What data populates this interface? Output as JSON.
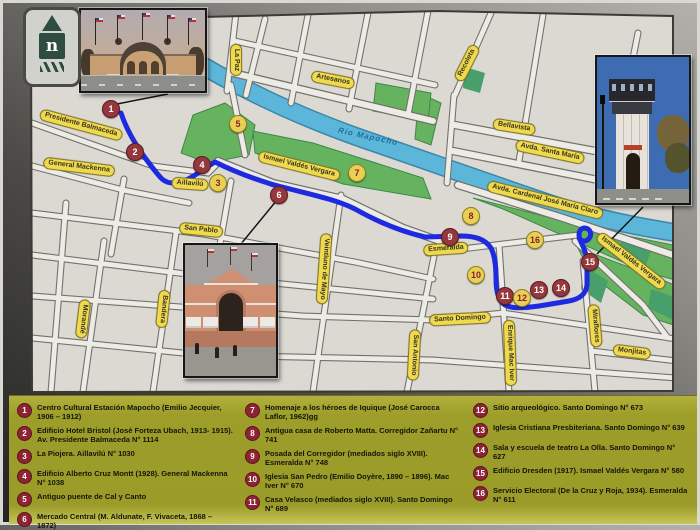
{
  "map": {
    "logo_letter": "n",
    "route_color": "#1e2ae0",
    "colors": {
      "paper": "#dcd9d3",
      "street": "#edebe6",
      "street_casing": "#72726c",
      "river": "#5cb6da",
      "park": "#66b35f",
      "park_dark": "#47a06b",
      "badge_bg": "#eed94f",
      "marker_red": "#94383d",
      "marker_yellow": "#e7d054"
    },
    "street_labels": [
      {
        "t": "Presidente Balmaceda",
        "x": 78,
        "y": 122,
        "r": 15
      },
      {
        "t": "General Mackenna",
        "x": 76,
        "y": 164,
        "r": 7
      },
      {
        "t": "Aillavilú",
        "x": 187,
        "y": 181,
        "r": 4
      },
      {
        "t": "San Pablo",
        "x": 198,
        "y": 227,
        "r": 6
      },
      {
        "t": "Artesanos",
        "x": 330,
        "y": 77,
        "r": 11
      },
      {
        "t": "La Paz",
        "x": 233,
        "y": 57,
        "r": 90
      },
      {
        "t": "Recoleta",
        "x": 464,
        "y": 60,
        "r": -63
      },
      {
        "t": "Bellavista",
        "x": 511,
        "y": 124,
        "r": 9
      },
      {
        "t": "Avda. Santa María",
        "x": 547,
        "y": 149,
        "r": 12
      },
      {
        "t": "Avda. Cardenal José María Claro",
        "x": 542,
        "y": 197,
        "r": 14
      },
      {
        "t": "Ismael Valdés Vergara",
        "x": 296,
        "y": 163,
        "r": 14
      },
      {
        "t": "Ismael Valdés Vergara",
        "x": 628,
        "y": 258,
        "r": 38
      },
      {
        "t": "Esmeralda",
        "x": 443,
        "y": 246,
        "r": -4
      },
      {
        "t": "Santo Domingo",
        "x": 457,
        "y": 316,
        "r": -3
      },
      {
        "t": "Morandé",
        "x": 80,
        "y": 316,
        "r": 97
      },
      {
        "t": "Bandera",
        "x": 160,
        "y": 306,
        "r": 96
      },
      {
        "t": "Veintiuno de Mayo",
        "x": 321,
        "y": 266,
        "r": 94
      },
      {
        "t": "San Antonio",
        "x": 411,
        "y": 352,
        "r": 93
      },
      {
        "t": "Enrique Mac Iver",
        "x": 507,
        "y": 350,
        "r": 88
      },
      {
        "t": "Miraflores",
        "x": 592,
        "y": 323,
        "r": 85
      },
      {
        "t": "Monjitas",
        "x": 629,
        "y": 349,
        "r": 7
      },
      {
        "t": "Río Mapocho",
        "x": 365,
        "y": 134,
        "r": 12,
        "style": "river"
      }
    ],
    "markers": [
      {
        "t": "1",
        "x": 108,
        "y": 106,
        "style": "red"
      },
      {
        "t": "2",
        "x": 132,
        "y": 149,
        "style": "red"
      },
      {
        "t": "3",
        "x": 215,
        "y": 180,
        "style": "yellow"
      },
      {
        "t": "4",
        "x": 199,
        "y": 162,
        "style": "red"
      },
      {
        "t": "5",
        "x": 235,
        "y": 121,
        "style": "yellow"
      },
      {
        "t": "6",
        "x": 276,
        "y": 192,
        "style": "red"
      },
      {
        "t": "7",
        "x": 354,
        "y": 170,
        "style": "yellow"
      },
      {
        "t": "8",
        "x": 468,
        "y": 213,
        "style": "yellow"
      },
      {
        "t": "9",
        "x": 447,
        "y": 234,
        "style": "red"
      },
      {
        "t": "10",
        "x": 473,
        "y": 272,
        "style": "yellow"
      },
      {
        "t": "11",
        "x": 502,
        "y": 293,
        "style": "red"
      },
      {
        "t": "12",
        "x": 519,
        "y": 295,
        "style": "yellow"
      },
      {
        "t": "13",
        "x": 536,
        "y": 287,
        "style": "red"
      },
      {
        "t": "14",
        "x": 558,
        "y": 285,
        "style": "red"
      },
      {
        "t": "15",
        "x": 587,
        "y": 259,
        "style": "red"
      },
      {
        "t": "16",
        "x": 532,
        "y": 237,
        "style": "yellow"
      }
    ]
  },
  "legend": {
    "col1": [
      {
        "n": "1",
        "t": "Centro Cultural Estación Mapocho (Emilio Jecquier, 1906 – 1912)"
      },
      {
        "n": "2",
        "t": "Edificio Hotel Bristol (José Forteza Ubach, 1913- 1915). Av. Presidente Balmaceda N° 1114"
      },
      {
        "n": "3",
        "t": "La Piojera. Aillavilú N° 1030"
      },
      {
        "n": "4",
        "t": "Edificio Alberto Cruz Montt (1928). General Mackenna N° 1038"
      },
      {
        "n": "5",
        "t": "Antiguo puente de Cal y Canto"
      },
      {
        "n": "6",
        "t": "Mercado Central (M. Aldunate, F. Vivaceta, 1868 – 1872)"
      }
    ],
    "col2": [
      {
        "n": "7",
        "t": "Homenaje a los héroes de Iquique (José Carocca Laflor, 1962)gg"
      },
      {
        "n": "8",
        "t": "Antigua casa de Roberto Matta. Corregidor Zañartu N° 741"
      },
      {
        "n": "9",
        "t": "Posada del Corregidor (mediados siglo XVIII). Esmeralda N° 748"
      },
      {
        "n": "10",
        "t": "Iglesia San Pedro (Emilio Doyère, 1890 – 1896). Mac Iver N° 670"
      },
      {
        "n": "11",
        "t": "Casa Velasco (mediados siglo XVIII). Santo Domingo N° 689"
      }
    ],
    "col3": [
      {
        "n": "12",
        "t": "Sitio arqueológico. Santo Domingo N° 673"
      },
      {
        "n": "13",
        "t": "Iglesia Cristiana Presbiteriana. Santo Domingo N° 639"
      },
      {
        "n": "14",
        "t": "Sala y escuela de teatro La Olla. Santo Domingo N° 627"
      },
      {
        "n": "15",
        "t": "Edificio Dresden (1917). Ismael Valdés Vergara N° 580"
      },
      {
        "n": "16",
        "t": "Servicio Electoral (De la Cruz y Roja, 1934). Esmeralda N° 611"
      }
    ]
  }
}
